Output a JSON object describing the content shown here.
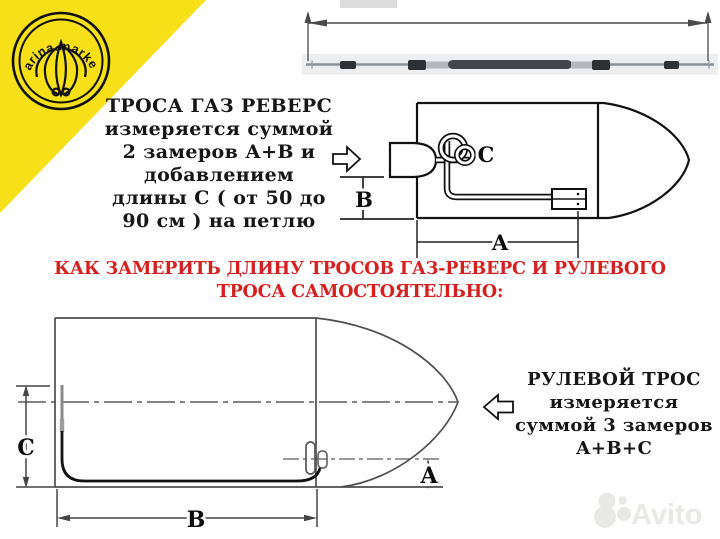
{
  "branding": {
    "logo_text": "Marina.markets",
    "corner_color": "#f7e017"
  },
  "texts": {
    "throttle_note": {
      "lines": [
        "ТРОСА ГАЗ РЕВЕРС",
        "измеряется суммой",
        "2 замеров А+В и",
        "добавлением",
        "длины С ( от 50 до",
        "90 см ) на петлю"
      ]
    },
    "heading": {
      "line1": "КАК ЗАМЕРИТЬ ДЛИНУ ТРОСОВ ГАЗ-РЕВЕРС И РУЛЕВОГО",
      "line2": "ТРОСА САМОСТОЯТЕЛЬНО:",
      "color": "#d6201f"
    },
    "steering_note": {
      "lines": [
        "РУЛЕВОЙ ТРОС",
        "измеряется",
        "суммой 3 замеров",
        "А+В+С"
      ]
    }
  },
  "diagram_labels": {
    "top_boat": {
      "a": "A",
      "b": "B",
      "c": "C"
    },
    "bottom_boat": {
      "a": "A",
      "b": "B",
      "c": "C"
    }
  },
  "watermark": {
    "text": "Avito"
  },
  "colors": {
    "heading_red": "#d6201f",
    "accent_yellow": "#f7e017",
    "watermark_gray": "#e8e8e6",
    "line_dark": "#111111"
  }
}
